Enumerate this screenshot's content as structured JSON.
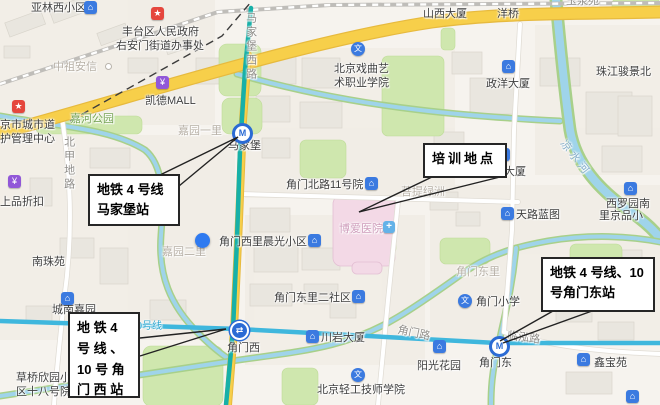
{
  "map": {
    "title": "metro-area-map",
    "colors": {
      "metro_line4": "#17b0a8",
      "metro_line10": "#3fb7dd",
      "road_yellow": "#f7cf4a",
      "water_blue": "#9fd4ea",
      "water_bank_green": "#a8d08a",
      "park_green": "#cfe7ae",
      "poi_blue": "#3b7ae0",
      "poi_red": "#e5463d",
      "poi_purple": "#9157d8",
      "hospital_pink": "#f3d9e6"
    },
    "icon_glyphs": {
      "building": "⌂",
      "gov": "★",
      "shopping": "¥",
      "school": "文",
      "hospital": "+",
      "dot": "",
      "minidot": ""
    },
    "callouts": [
      {
        "id": "callout-majiapu",
        "name": "callout-metro4-majiapu-station",
        "lines": [
          "地铁 4 号线",
          "马家堡站"
        ]
      },
      {
        "id": "callout-training",
        "name": "callout-training-location",
        "lines": [
          "培训地点"
        ]
      },
      {
        "id": "callout-jiaomen-west",
        "name": "callout-metro4-10-jiaomen-west-station",
        "lines": [
          "地 铁 4",
          "号 线 、",
          "10 号 角",
          "门 西 站"
        ]
      },
      {
        "id": "callout-jiaomen-east",
        "name": "callout-metro4-10-jiaomen-east-station",
        "lines": [
          "地铁 4 号线、10",
          "号角门东站"
        ]
      }
    ],
    "stations": [
      {
        "label": "马家堡",
        "x": 232,
        "y": 123,
        "style": "ring",
        "glyph": "M",
        "name": "metro-station-icon-majiapu"
      },
      {
        "label": "角门西",
        "x": 230,
        "y": 321,
        "style": "fill",
        "glyph": "⇄",
        "name": "metro-station-icon-jiaomen-west"
      },
      {
        "label": "角门东",
        "x": 489,
        "y": 336,
        "style": "ring",
        "glyph": "M",
        "name": "metro-station-icon-jiaomen-east"
      }
    ],
    "labels": [
      {
        "t": "亚林西小区",
        "x": 31,
        "y": 2,
        "c": "dark"
      },
      {
        "t": "丰台区人民政府",
        "x": 122,
        "y": 26,
        "c": "dark"
      },
      {
        "t": "右安门街道办事处",
        "x": 116,
        "y": 40,
        "c": "dark"
      },
      {
        "t": "中祖安信",
        "x": 53,
        "y": 61,
        "c": "faded"
      },
      {
        "t": "山西大厦",
        "x": 423,
        "y": 8,
        "c": "dark"
      },
      {
        "t": "洋桥",
        "x": 497,
        "y": 8,
        "c": "dark"
      },
      {
        "t": "玉泉苑",
        "x": 566,
        "y": -5,
        "c": "gray"
      },
      {
        "t": "珠江骏景北",
        "x": 596,
        "y": 66,
        "c": "dark"
      },
      {
        "t": "政洋大厦",
        "x": 486,
        "y": 78,
        "c": "dark"
      },
      {
        "t": "北京戏曲艺",
        "x": 334,
        "y": 63,
        "c": "dark"
      },
      {
        "t": "术职业学院",
        "x": 334,
        "y": 77,
        "c": "dark"
      },
      {
        "t": "凯德MALL",
        "x": 145,
        "y": 95,
        "c": "dark"
      },
      {
        "t": "嘉河公园",
        "x": 70,
        "y": 113,
        "c": "green"
      },
      {
        "t": "嘉园一里",
        "x": 178,
        "y": 125,
        "c": "faded"
      },
      {
        "t": "北甲地路",
        "x": 62,
        "y": 136,
        "c": "gray vert"
      },
      {
        "t": "马家堡西路",
        "x": 244,
        "y": 12,
        "c": "gray vert"
      },
      {
        "t": "京市城市道",
        "x": 0,
        "y": 119,
        "c": "dark"
      },
      {
        "t": "护管理中心",
        "x": 0,
        "y": 133,
        "c": "dark"
      },
      {
        "t": "上品折扣",
        "x": 0,
        "y": 196,
        "c": "dark"
      },
      {
        "t": "马家堡",
        "x": 228,
        "y": 140,
        "c": "dark"
      },
      {
        "t": "角门北路11号院",
        "x": 286,
        "y": 179,
        "c": "dark"
      },
      {
        "t": "菩提绿洲",
        "x": 401,
        "y": 186,
        "c": "faded"
      },
      {
        "t": "博爱医院",
        "x": 339,
        "y": 223,
        "c": "pink"
      },
      {
        "t": "大厦",
        "x": 504,
        "y": 166,
        "c": "dark"
      },
      {
        "t": "天路蓝图",
        "x": 516,
        "y": 209,
        "c": "dark"
      },
      {
        "t": "凉水河",
        "x": 567,
        "y": 138,
        "c": "water",
        "r": 52
      },
      {
        "t": "西罗园南",
        "x": 606,
        "y": 198,
        "c": "dark"
      },
      {
        "t": "里京品小",
        "x": 599,
        "y": 210,
        "c": "dark"
      },
      {
        "t": "角门西里晨光小区",
        "x": 219,
        "y": 236,
        "c": "dark"
      },
      {
        "t": "嘉园二里",
        "x": 162,
        "y": 246,
        "c": "faded"
      },
      {
        "t": "角门东里",
        "x": 456,
        "y": 266,
        "c": "faded"
      },
      {
        "t": "角门东里二社区",
        "x": 274,
        "y": 292,
        "c": "dark"
      },
      {
        "t": "南珠苑",
        "x": 32,
        "y": 256,
        "c": "dark"
      },
      {
        "t": "城南嘉园",
        "x": 52,
        "y": 304,
        "c": "dark"
      },
      {
        "t": "10号线",
        "x": 131,
        "y": 321,
        "c": "line10"
      },
      {
        "t": "草桥欣园小",
        "x": 16,
        "y": 372,
        "c": "dark"
      },
      {
        "t": "区十八号院",
        "x": 16,
        "y": 386,
        "c": "dark"
      },
      {
        "t": "角门西",
        "x": 227,
        "y": 342,
        "c": "dark"
      },
      {
        "t": "川岩大厦",
        "x": 321,
        "y": 332,
        "c": "dark"
      },
      {
        "t": "角门小学",
        "x": 476,
        "y": 296,
        "c": "dark"
      },
      {
        "t": "角门路",
        "x": 399,
        "y": 324,
        "c": "gray",
        "r": 12
      },
      {
        "t": "临泓路",
        "x": 508,
        "y": 330,
        "c": "gray",
        "r": 7
      },
      {
        "t": "角门东",
        "x": 479,
        "y": 357,
        "c": "dark"
      },
      {
        "t": "鑫宝苑",
        "x": 594,
        "y": 357,
        "c": "dark"
      },
      {
        "t": "阳光花园",
        "x": 417,
        "y": 360,
        "c": "dark"
      },
      {
        "t": "北京轻工技师学院",
        "x": 317,
        "y": 384,
        "c": "dark"
      }
    ],
    "badges": [
      {
        "type": "building",
        "x": 84,
        "y": 1,
        "name": "poi-icon-yalinxi"
      },
      {
        "type": "gov",
        "x": 151,
        "y": 7,
        "name": "poi-icon-subdistrict-office"
      },
      {
        "type": "gov",
        "x": 12,
        "y": 100,
        "name": "poi-icon-road-maintenance-center"
      },
      {
        "type": "shopping",
        "x": 156,
        "y": 76,
        "name": "poi-icon-kaide-mall"
      },
      {
        "type": "shopping",
        "x": 8,
        "y": 175,
        "name": "poi-icon-shangpin-outlet"
      },
      {
        "type": "school",
        "x": 351,
        "y": 42,
        "name": "poi-icon-opera-college"
      },
      {
        "type": "building",
        "x": 502,
        "y": 60,
        "name": "poi-icon-zhengyang-tower"
      },
      {
        "type": "building",
        "x": 365,
        "y": 177,
        "name": "poi-icon-jiaomen-beilu-11"
      },
      {
        "type": "building",
        "x": 497,
        "y": 148,
        "name": "poi-icon-tower-behind-callout"
      },
      {
        "type": "building",
        "x": 501,
        "y": 207,
        "name": "poi-icon-tianlu-lantu"
      },
      {
        "type": "building",
        "x": 624,
        "y": 182,
        "name": "poi-icon-xiluoyuan"
      },
      {
        "type": "building",
        "x": 308,
        "y": 234,
        "name": "poi-icon-chenguang-community"
      },
      {
        "type": "building",
        "x": 352,
        "y": 290,
        "name": "poi-icon-jiaomen-dongli-2"
      },
      {
        "type": "building",
        "x": 61,
        "y": 292,
        "name": "poi-icon-chengnan-jiayuan"
      },
      {
        "type": "building",
        "x": 111,
        "y": 351,
        "name": "poi-icon-caoqiao-xinyuan"
      },
      {
        "type": "building",
        "x": 306,
        "y": 330,
        "name": "poi-icon-chuanyan-tower"
      },
      {
        "type": "school",
        "x": 458,
        "y": 294,
        "name": "poi-icon-jiaomen-primary-school"
      },
      {
        "type": "school",
        "x": 351,
        "y": 368,
        "name": "poi-icon-light-industry-college"
      },
      {
        "type": "building",
        "x": 433,
        "y": 340,
        "name": "poi-icon-yangguang-garden"
      },
      {
        "type": "building",
        "x": 577,
        "y": 353,
        "name": "poi-icon-xinbaoyuan"
      },
      {
        "type": "building",
        "x": 626,
        "y": 390,
        "name": "poi-icon-bottom-right"
      },
      {
        "type": "hospital",
        "x": 383,
        "y": 221,
        "name": "hospital-icon-boai"
      },
      {
        "type": "dot",
        "x": 195,
        "y": 233,
        "name": "location-dot-jiayuan-erli"
      },
      {
        "type": "minidot",
        "x": 105,
        "y": 63,
        "name": "poi-dot-zhongzuanxin"
      }
    ]
  }
}
